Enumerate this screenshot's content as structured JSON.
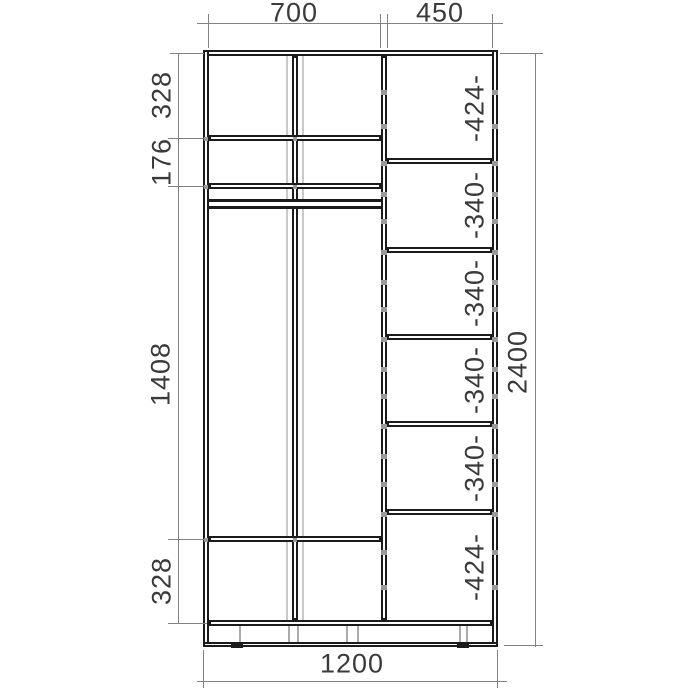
{
  "dims": {
    "top": [
      "700",
      "450"
    ],
    "left": [
      "328",
      "176",
      "1408",
      "328"
    ],
    "right_col": [
      "-424-",
      "-340-",
      "-340-",
      "-340-",
      "-340-",
      "-424-"
    ],
    "overall_height": "2400",
    "overall_width": "1200"
  },
  "colors": {
    "line": "#1b1b1b",
    "dim_line": "#828282",
    "text": "#3a3a3a",
    "door_line": "#c9c9c9",
    "screw_mark": "#9a9a9a",
    "background": "#ffffff"
  }
}
